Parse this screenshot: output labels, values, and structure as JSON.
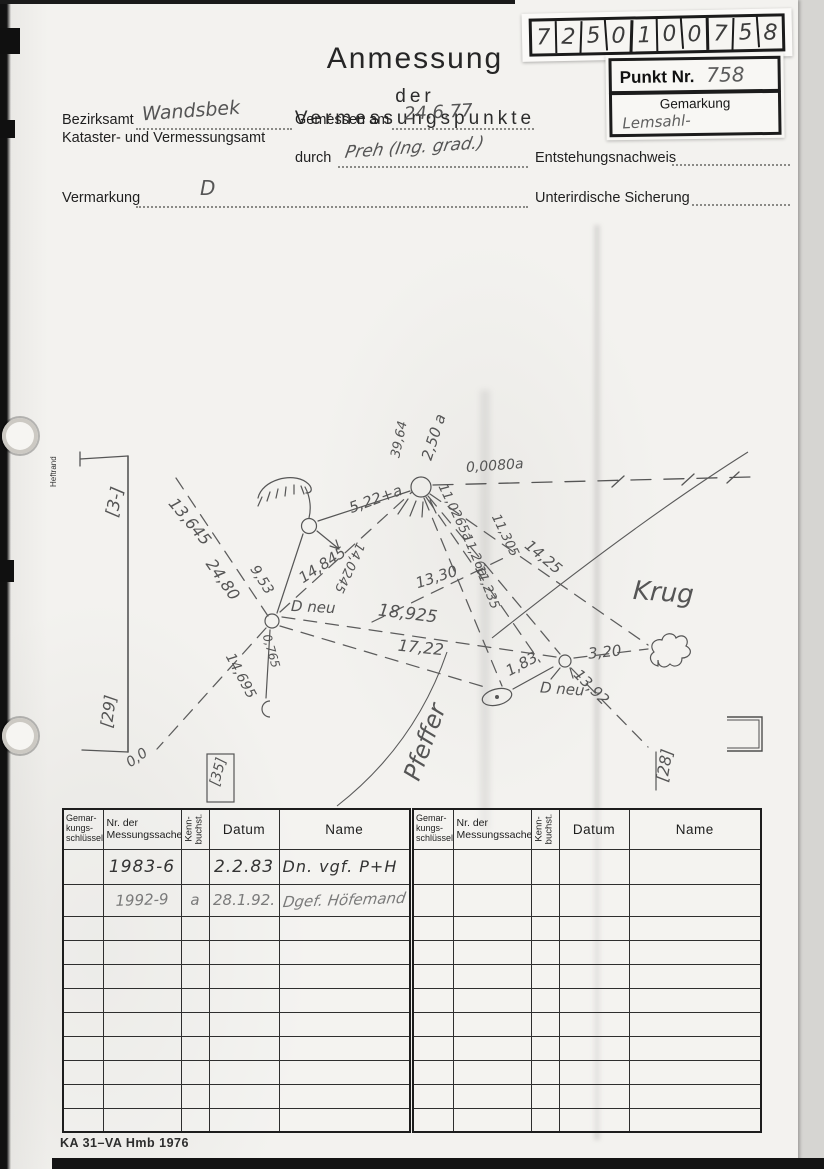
{
  "sticker": {
    "digits": [
      "7",
      "2",
      "5",
      "0",
      "1",
      "0",
      "0",
      "7",
      "5",
      "8"
    ]
  },
  "point_box": {
    "punkt_label": "Punkt Nr.",
    "punkt_value": "758",
    "gemarkung_label": "Gemarkung",
    "gemarkung_value": "Lemsahl-"
  },
  "title": {
    "line1": "Anmessung",
    "line2": "der Vermessungspunkte"
  },
  "fields": {
    "bezirksamt_label": "Bezirksamt",
    "bezirksamt_value": "Wandsbek",
    "amt_line": "Kataster- und Vermessungsamt",
    "gemessen_label": "Gemessen am",
    "gemessen_value": "24.6.77",
    "durch_label": "durch",
    "durch_value": "Preh (Ing. grad.)",
    "vermarkung_label": "Vermarkung",
    "vermarkung_value": "D",
    "entstehung_label": "Entstehungsnachweis",
    "sicherung_label": "Unterirdische Sicherung"
  },
  "sketch": {
    "margin_label": "Heftrand",
    "labels": {
      "b3": "[3-]",
      "b29": "[29]",
      "b35": "[35]",
      "b28": "[28]",
      "zero": "0,0",
      "m13645": "13,645",
      "m2480": "24,80",
      "m953": "9,53",
      "m14845": "14,845",
      "m140245": "14,0245",
      "m522": "5,22+a",
      "m250": "2,50 a",
      "m3964": "39,64",
      "m00080": "0,0080a",
      "m110265": "11,0265a",
      "m11305": "11,305",
      "m1126": "11,26a",
      "m11235": "11,235",
      "m1330": "13,30",
      "m1425": "14,25",
      "m18925": "18,925",
      "m1722": "17,22",
      "m14695": "14,695",
      "m0765": "0,765",
      "m183": "1,83",
      "m320": "3,20",
      "m1392": "13,92",
      "dneu1": "D neu",
      "dneu2": "D neu",
      "krug": "Krug",
      "pfeffer": "Pfeffer"
    }
  },
  "table": {
    "headers": {
      "gemarkung": [
        "Gemar-",
        "kungs-",
        "schlüssel"
      ],
      "nr": [
        "Nr. der",
        "Messungssache"
      ],
      "kenn": [
        "Kenn-",
        "buchst."
      ],
      "datum": "Datum",
      "name": "Name"
    },
    "left_rows": [
      {
        "nr": "1983-6",
        "kenn": "",
        "datum": "2.2.83",
        "name": "Dn. vgf. P+H"
      },
      {
        "nr": "1992-9",
        "kenn": "a",
        "datum": "28.1.92.",
        "name": "Dgef. Höfemand"
      }
    ]
  },
  "footer": {
    "form_code": "KA 31–VA Hmb 1976"
  }
}
